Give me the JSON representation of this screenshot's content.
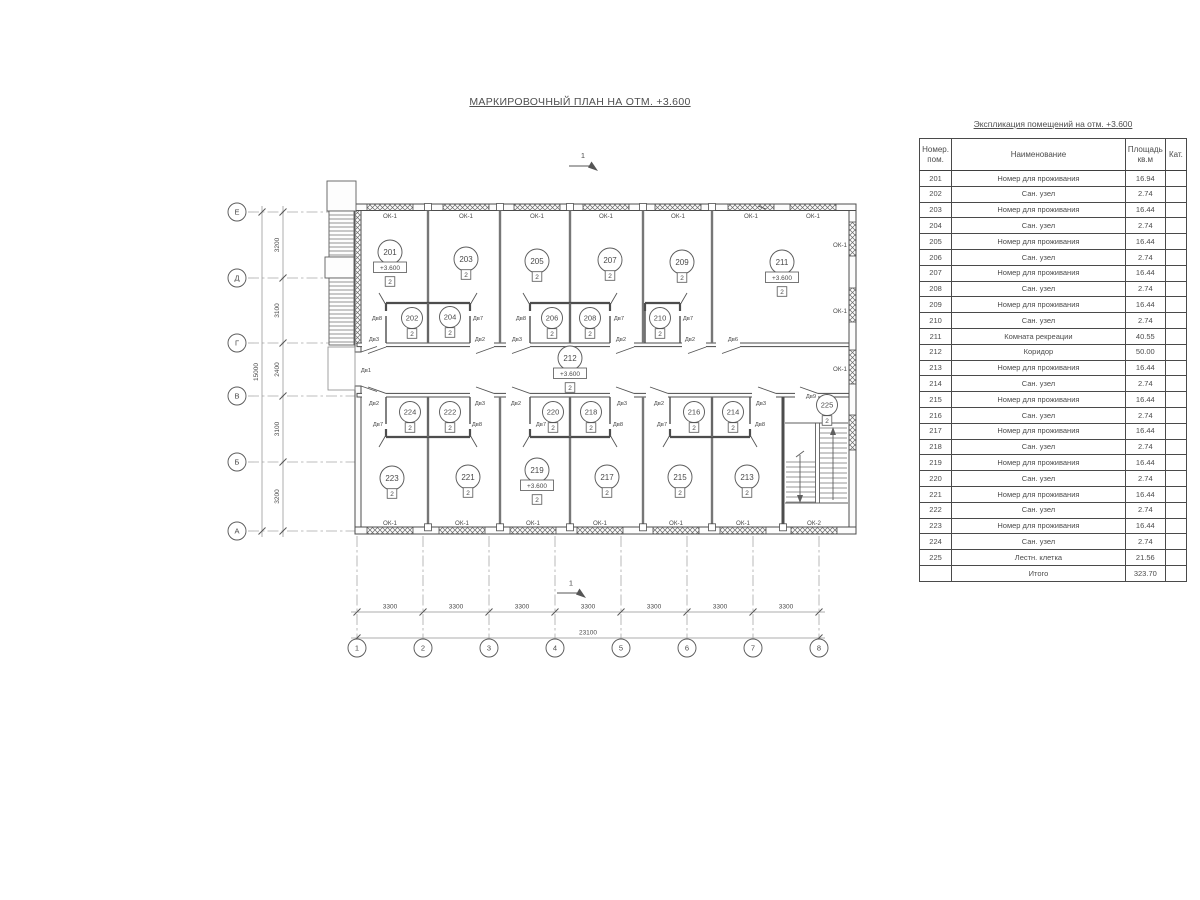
{
  "title": "МАРКИРОВОЧНЫЙ ПЛАН НА ОТМ. +3.600",
  "table": {
    "title": "Экспликация помещений на отм. +3.600",
    "headers": {
      "num": "Номер.\nпом.",
      "name": "Наименование",
      "area": "Площадь\nкв.м",
      "cat": "Кат."
    },
    "rows": [
      {
        "num": "201",
        "name": "Номер для проживания",
        "area": "16.94",
        "cat": ""
      },
      {
        "num": "202",
        "name": "Сан. узел",
        "area": "2.74",
        "cat": ""
      },
      {
        "num": "203",
        "name": "Номер для проживания",
        "area": "16.44",
        "cat": ""
      },
      {
        "num": "204",
        "name": "Сан. узел",
        "area": "2.74",
        "cat": ""
      },
      {
        "num": "205",
        "name": "Номер для проживания",
        "area": "16.44",
        "cat": ""
      },
      {
        "num": "206",
        "name": "Сан. узел",
        "area": "2.74",
        "cat": ""
      },
      {
        "num": "207",
        "name": "Номер для проживания",
        "area": "16.44",
        "cat": ""
      },
      {
        "num": "208",
        "name": "Сан. узел",
        "area": "2.74",
        "cat": ""
      },
      {
        "num": "209",
        "name": "Номер для проживания",
        "area": "16.44",
        "cat": ""
      },
      {
        "num": "210",
        "name": "Сан. узел",
        "area": "2.74",
        "cat": ""
      },
      {
        "num": "211",
        "name": "Комната рекреации",
        "area": "40.55",
        "cat": ""
      },
      {
        "num": "212",
        "name": "Коридор",
        "area": "50.00",
        "cat": ""
      },
      {
        "num": "213",
        "name": "Номер для проживания",
        "area": "16.44",
        "cat": ""
      },
      {
        "num": "214",
        "name": "Сан. узел",
        "area": "2.74",
        "cat": ""
      },
      {
        "num": "215",
        "name": "Номер для проживания",
        "area": "16.44",
        "cat": ""
      },
      {
        "num": "216",
        "name": "Сан. узел",
        "area": "2.74",
        "cat": ""
      },
      {
        "num": "217",
        "name": "Номер для проживания",
        "area": "16.44",
        "cat": ""
      },
      {
        "num": "218",
        "name": "Сан. узел",
        "area": "2.74",
        "cat": ""
      },
      {
        "num": "219",
        "name": "Номер для проживания",
        "area": "16.44",
        "cat": ""
      },
      {
        "num": "220",
        "name": "Сан. узел",
        "area": "2.74",
        "cat": ""
      },
      {
        "num": "221",
        "name": "Номер для проживания",
        "area": "16.44",
        "cat": ""
      },
      {
        "num": "222",
        "name": "Сан. узел",
        "area": "2.74",
        "cat": ""
      },
      {
        "num": "223",
        "name": "Номер для проживания",
        "area": "16.44",
        "cat": ""
      },
      {
        "num": "224",
        "name": "Сан. узел",
        "area": "2.74",
        "cat": ""
      },
      {
        "num": "225",
        "name": "Лестн. клетка",
        "area": "21.56",
        "cat": ""
      }
    ],
    "total_label": "Итого",
    "total_area": "323.70"
  },
  "plan": {
    "section_mark": "1",
    "level_mark": "+3.600",
    "category_mark": "2",
    "axes_left": [
      "Е",
      "Д",
      "Г",
      "В",
      "Б",
      "А"
    ],
    "axes_bottom": [
      "1",
      "2",
      "3",
      "4",
      "5",
      "6",
      "7",
      "8"
    ],
    "dims_left": [
      "3200",
      "3100",
      "2400",
      "3100",
      "3200"
    ],
    "dims_left_total": "15000",
    "dims_bottom": [
      "3300",
      "3300",
      "3300",
      "3300",
      "3300",
      "3300",
      "3300"
    ],
    "dims_bottom_total": "23100",
    "rooms": [
      {
        "num": "201",
        "x": 390,
        "y": 252,
        "level": true
      },
      {
        "num": "203",
        "x": 466,
        "y": 259
      },
      {
        "num": "205",
        "x": 537,
        "y": 261
      },
      {
        "num": "207",
        "x": 610,
        "y": 260
      },
      {
        "num": "209",
        "x": 682,
        "y": 262
      },
      {
        "num": "211",
        "x": 782,
        "y": 262,
        "level": true
      },
      {
        "num": "202",
        "x": 412,
        "y": 318,
        "small": true
      },
      {
        "num": "204",
        "x": 450,
        "y": 317,
        "small": true
      },
      {
        "num": "206",
        "x": 552,
        "y": 318,
        "small": true
      },
      {
        "num": "208",
        "x": 590,
        "y": 318,
        "small": true
      },
      {
        "num": "210",
        "x": 660,
        "y": 318,
        "small": true
      },
      {
        "num": "212",
        "x": 570,
        "y": 358,
        "level": true
      },
      {
        "num": "224",
        "x": 410,
        "y": 412,
        "small": true
      },
      {
        "num": "222",
        "x": 450,
        "y": 412,
        "small": true
      },
      {
        "num": "220",
        "x": 553,
        "y": 412,
        "small": true
      },
      {
        "num": "218",
        "x": 591,
        "y": 412,
        "small": true
      },
      {
        "num": "216",
        "x": 694,
        "y": 412,
        "small": true
      },
      {
        "num": "214",
        "x": 733,
        "y": 412,
        "small": true
      },
      {
        "num": "223",
        "x": 392,
        "y": 478
      },
      {
        "num": "221",
        "x": 468,
        "y": 477
      },
      {
        "num": "219",
        "x": 537,
        "y": 470,
        "level": true
      },
      {
        "num": "217",
        "x": 607,
        "y": 477
      },
      {
        "num": "215",
        "x": 680,
        "y": 477
      },
      {
        "num": "213",
        "x": 747,
        "y": 477
      },
      {
        "num": "225",
        "x": 827,
        "y": 405,
        "small": true
      }
    ],
    "door_labels": [
      {
        "t": "Дв8",
        "x": 377,
        "y": 318
      },
      {
        "t": "Дв7",
        "x": 478,
        "y": 318
      },
      {
        "t": "Дв8",
        "x": 521,
        "y": 318
      },
      {
        "t": "Дв7",
        "x": 619,
        "y": 318
      },
      {
        "t": "Дв7",
        "x": 688,
        "y": 318
      },
      {
        "t": "Дв3",
        "x": 374,
        "y": 339
      },
      {
        "t": "Дв2",
        "x": 480,
        "y": 339
      },
      {
        "t": "Дв3",
        "x": 517,
        "y": 339
      },
      {
        "t": "Дв2",
        "x": 621,
        "y": 339
      },
      {
        "t": "Дв2",
        "x": 690,
        "y": 339
      },
      {
        "t": "Дв6",
        "x": 733,
        "y": 339
      },
      {
        "t": "Дв1",
        "x": 366,
        "y": 370
      },
      {
        "t": "Дв2",
        "x": 374,
        "y": 403
      },
      {
        "t": "Дв3",
        "x": 480,
        "y": 403
      },
      {
        "t": "Дв2",
        "x": 516,
        "y": 403
      },
      {
        "t": "Дв3",
        "x": 622,
        "y": 403
      },
      {
        "t": "Дв2",
        "x": 659,
        "y": 403
      },
      {
        "t": "Дв3",
        "x": 761,
        "y": 403
      },
      {
        "t": "Дв9",
        "x": 811,
        "y": 396
      },
      {
        "t": "Дв7",
        "x": 378,
        "y": 424
      },
      {
        "t": "Дв8",
        "x": 477,
        "y": 424
      },
      {
        "t": "Дв7",
        "x": 541,
        "y": 424
      },
      {
        "t": "Дв8",
        "x": 618,
        "y": 424
      },
      {
        "t": "Дв7",
        "x": 662,
        "y": 424
      },
      {
        "t": "Дв8",
        "x": 760,
        "y": 424
      }
    ],
    "window_labels": [
      {
        "t": "ОК-1",
        "x": 390,
        "y": 216
      },
      {
        "t": "ОК-1",
        "x": 466,
        "y": 216
      },
      {
        "t": "ОК-1",
        "x": 537,
        "y": 216
      },
      {
        "t": "ОК-1",
        "x": 606,
        "y": 216
      },
      {
        "t": "ОК-1",
        "x": 678,
        "y": 216
      },
      {
        "t": "ОК-1",
        "x": 751,
        "y": 216
      },
      {
        "t": "ОК-1",
        "x": 813,
        "y": 216
      },
      {
        "t": "ОК-1",
        "x": 840,
        "y": 245
      },
      {
        "t": "ОК-1",
        "x": 840,
        "y": 311
      },
      {
        "t": "ОК-1",
        "x": 840,
        "y": 369
      },
      {
        "t": "ОК-1",
        "x": 390,
        "y": 523
      },
      {
        "t": "ОК-1",
        "x": 462,
        "y": 523
      },
      {
        "t": "ОК-1",
        "x": 533,
        "y": 523
      },
      {
        "t": "ОК-1",
        "x": 600,
        "y": 523
      },
      {
        "t": "ОК-1",
        "x": 676,
        "y": 523
      },
      {
        "t": "ОК-1",
        "x": 743,
        "y": 523
      },
      {
        "t": "ОК-2",
        "x": 814,
        "y": 523
      }
    ]
  }
}
